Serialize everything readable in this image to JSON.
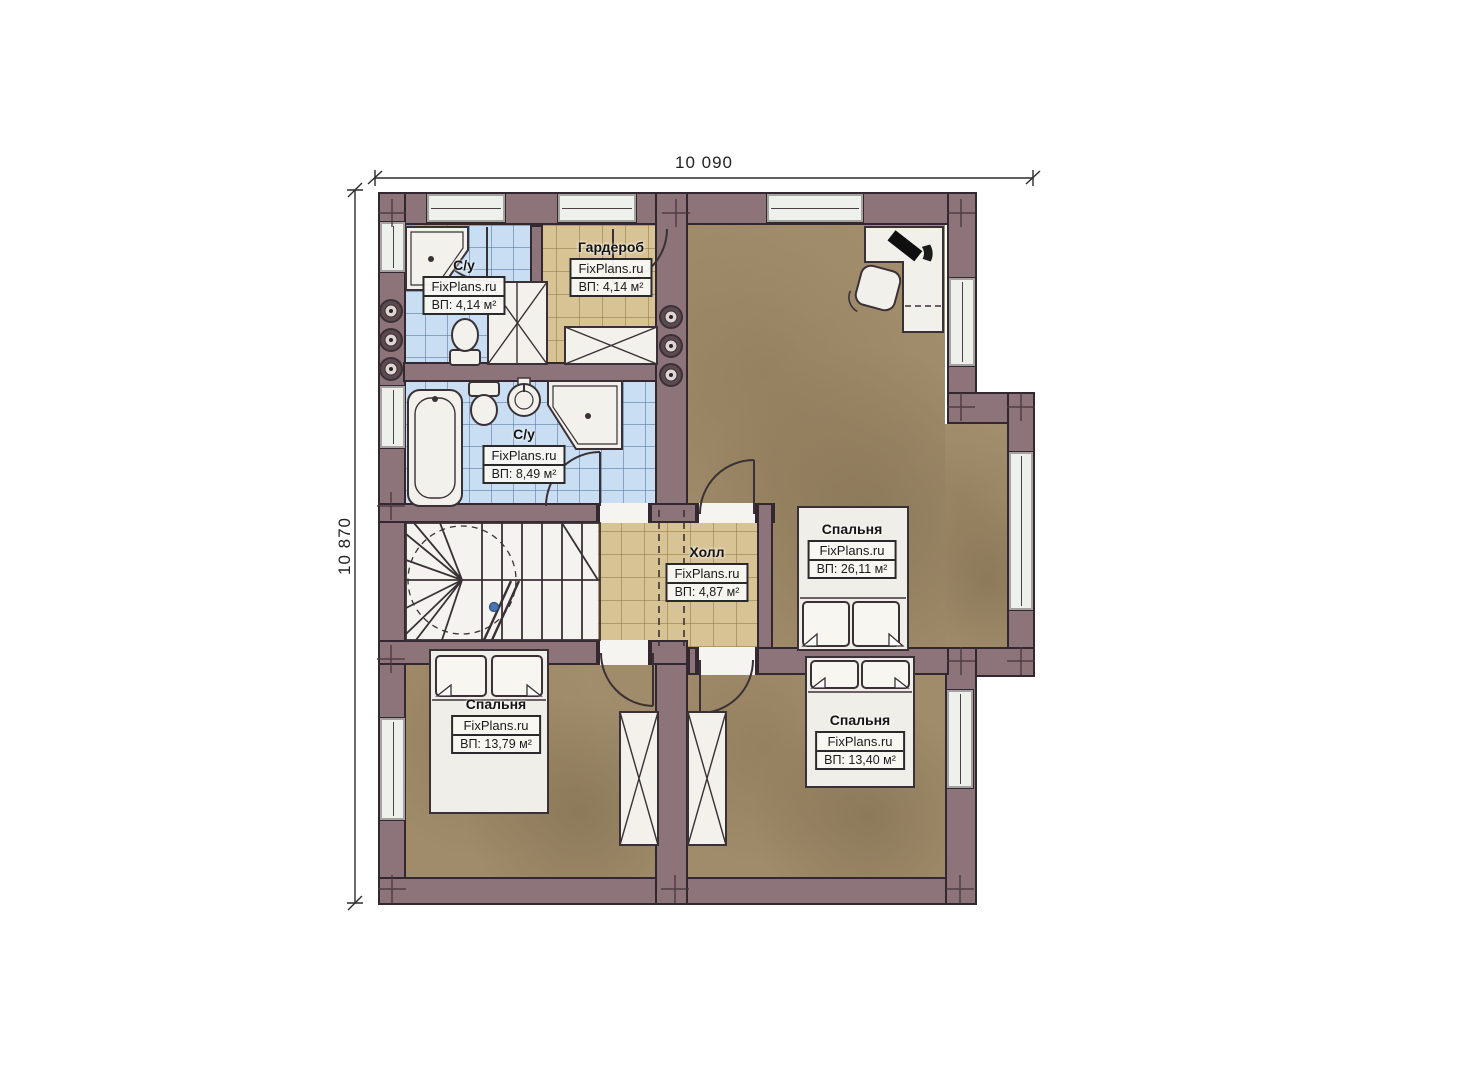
{
  "dimensions": {
    "top": "10 090",
    "left": "10 870"
  },
  "rooms": {
    "bath_top": {
      "name": "С/у",
      "brand": "FixPlans.ru",
      "area": "ВП: 4,14 м²"
    },
    "wardrobe": {
      "name": "Гардероб",
      "brand": "FixPlans.ru",
      "area": "ВП: 4,14 м²"
    },
    "bath_main": {
      "name": "С/у",
      "brand": "FixPlans.ru",
      "area": "ВП: 8,49 м²"
    },
    "hall": {
      "name": "Холл",
      "brand": "FixPlans.ru",
      "area": "ВП: 4,87 м²"
    },
    "bedroom_master": {
      "name": "Спальня",
      "brand": "FixPlans.ru",
      "area": "ВП: 26,11 м²"
    },
    "bedroom_left": {
      "name": "Спальня",
      "brand": "FixPlans.ru",
      "area": "ВП: 13,79 м²"
    },
    "bedroom_right": {
      "name": "Спальня",
      "brand": "FixPlans.ru",
      "area": "ВП: 13,40 м²"
    }
  },
  "colors": {
    "wall": "#8d747b",
    "wall_line": "#332830",
    "floor_wood": "#a08c6a",
    "tile_bath": "#c9def3",
    "tile_hall": "#d8c395",
    "fixture_white": "#f2f1eb"
  }
}
